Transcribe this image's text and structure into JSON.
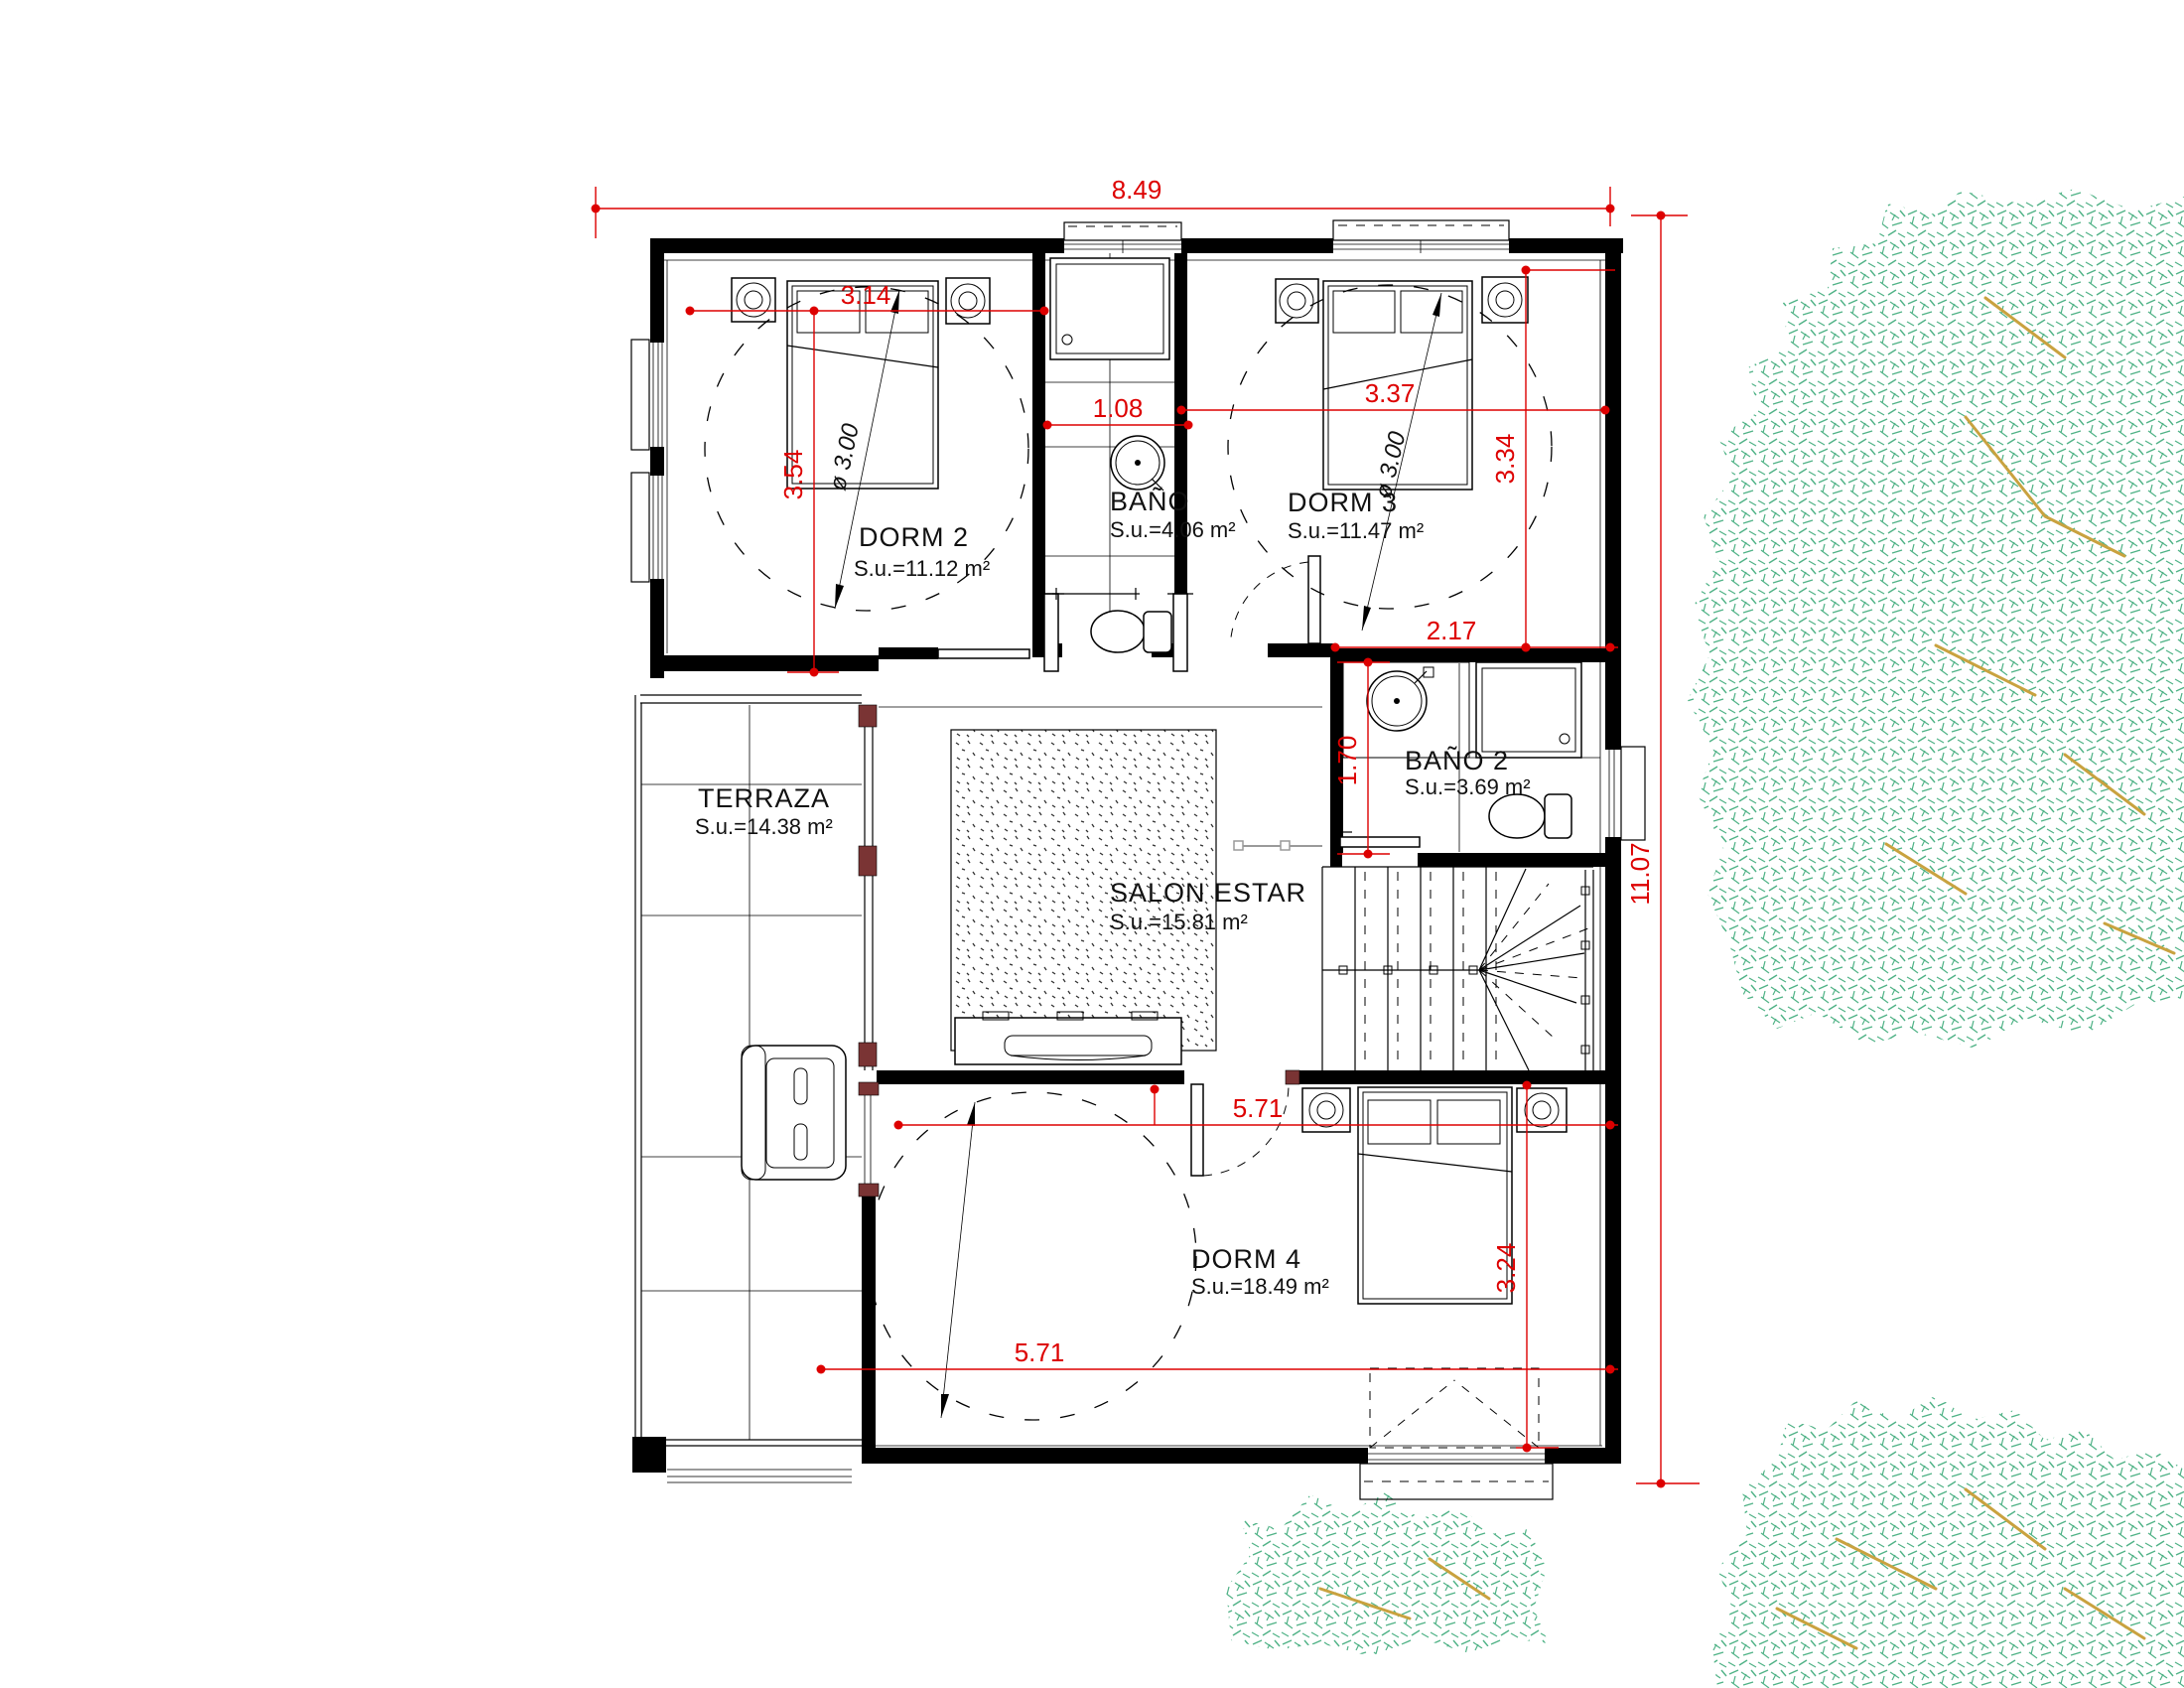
{
  "plan": {
    "rooms": [
      {
        "name": "DORM 2",
        "area": "S.u.=11.12 m²"
      },
      {
        "name": "BAÑO",
        "area": "S.u.=4.06 m²"
      },
      {
        "name": "DORM 3",
        "area": "S.u.=11.47 m²"
      },
      {
        "name": "TERRAZA",
        "area": "S.u.=14.38 m²"
      },
      {
        "name": "SALON ESTAR",
        "area": "S.u.=15.81 m²"
      },
      {
        "name": "BAÑO 2",
        "area": "S.u.=3.69 m²"
      },
      {
        "name": "DORM 4",
        "area": "S.u.=18.49 m²"
      }
    ],
    "dimensions": {
      "overall_width": "8.49",
      "overall_height": "11.07",
      "dorm2_width": "3.14",
      "dorm2_height": "3.54",
      "bano_width": "1.08",
      "dorm3_width": "3.37",
      "dorm3_height": "3.34",
      "bano2_width": "2.17",
      "bano2_height": "1.70",
      "dorm4_width_top": "5.71",
      "dorm4_width_bottom": "5.71",
      "dorm4_height": "3.24"
    },
    "annotations": {
      "circle_dorm2": "ø 3.00",
      "circle_dorm3": "ø 3.00"
    },
    "colors": {
      "dimension": "#dd0000",
      "walls": "#000000",
      "foliage": "#4fb286",
      "branches": "#c9a23f",
      "door_accent": "#7a3434"
    }
  }
}
